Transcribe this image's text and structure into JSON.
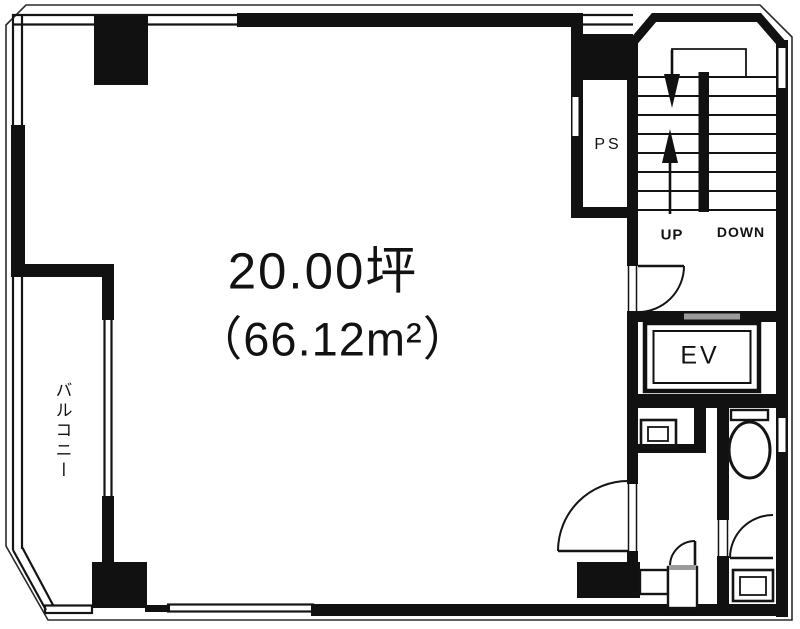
{
  "plan": {
    "area": {
      "tsubo_label": "20.00坪",
      "sqm_label": "（66.12m²）"
    },
    "balcony": {
      "label": "バルコニー"
    },
    "pipe_space": {
      "label": "PS"
    },
    "stairs": {
      "up_label": "UP",
      "down_label": "DOWN"
    },
    "elevator": {
      "label": "EV"
    },
    "colors": {
      "wall": "#111111",
      "line": "#1c1c1c",
      "elevator_door": "#9b9b9b",
      "background": "#ffffff",
      "text": "#121212"
    }
  }
}
